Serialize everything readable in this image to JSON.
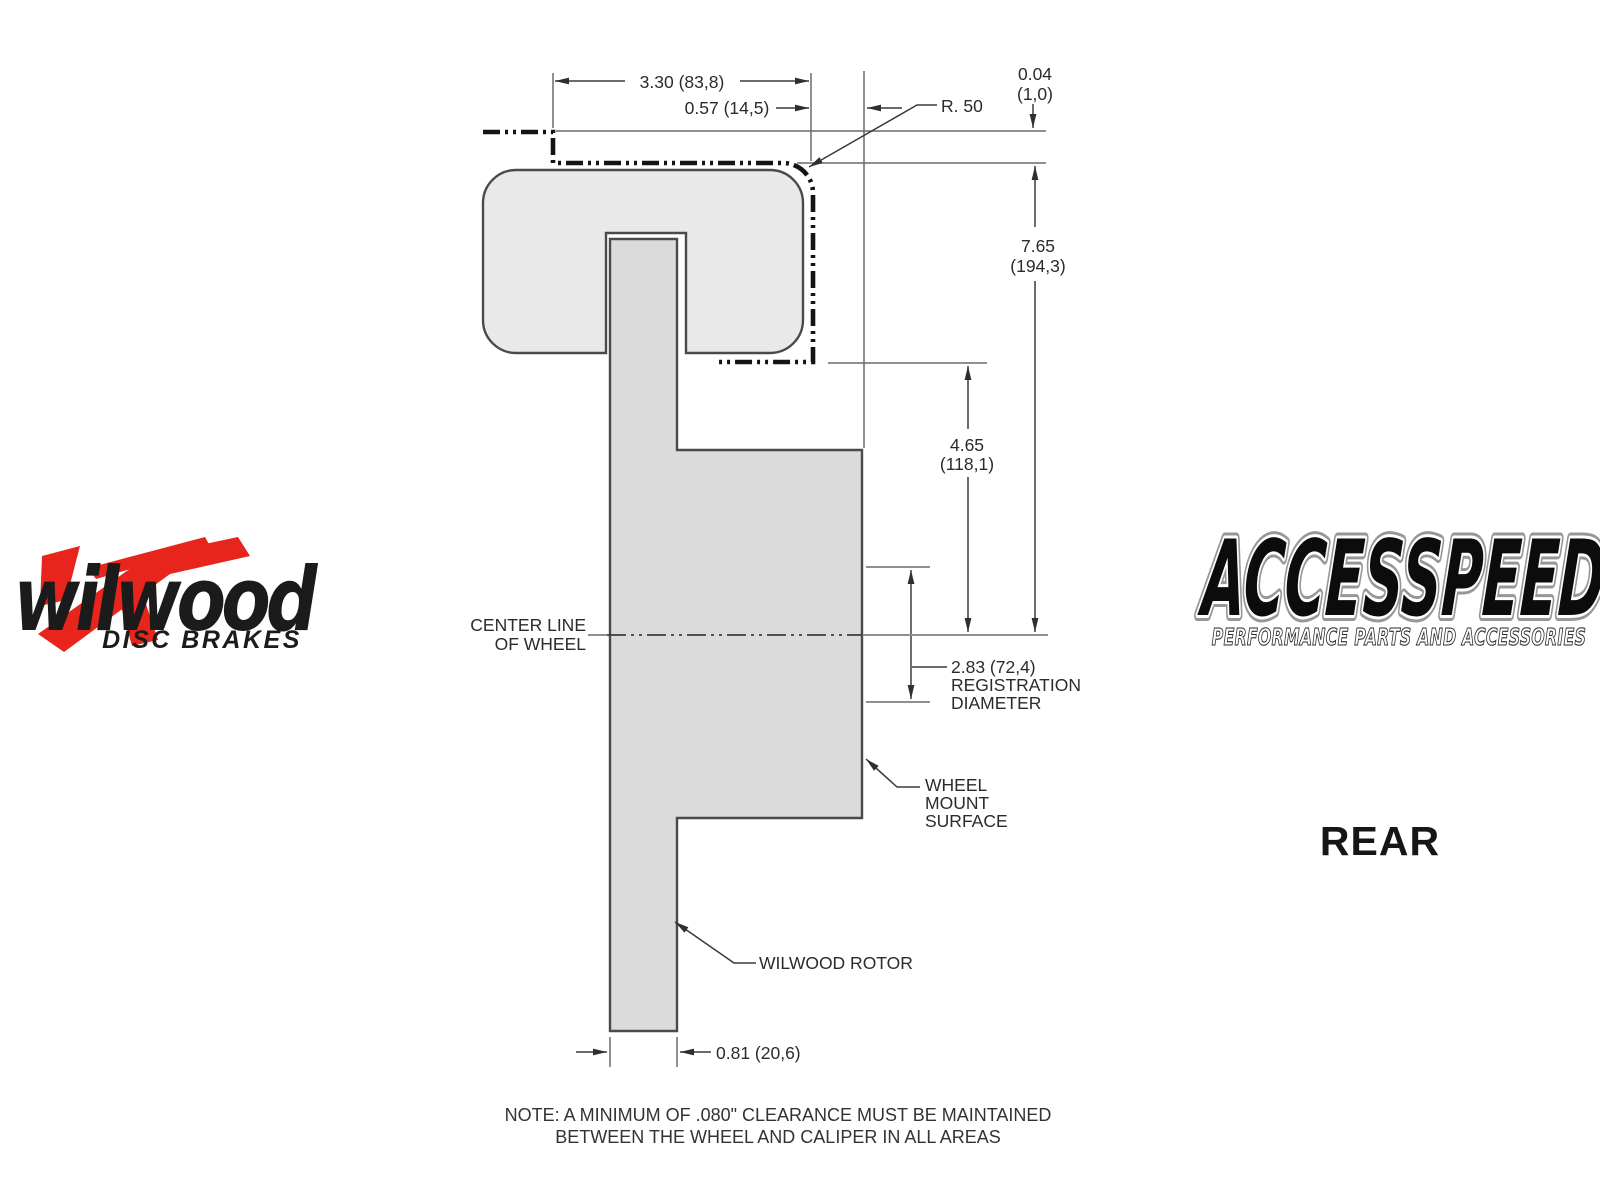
{
  "colors": {
    "accent_red": "#e8251c",
    "caliper_fill": "#e9e9e9",
    "rotor_fill": "#dbdbdb",
    "phantom_line": "#141414",
    "thin_line": "#6a6a6a",
    "text": "#2b2b2b"
  },
  "drawing": {
    "dim_3_30": "3.30 (83,8)",
    "dim_0_57": "0.57 (14,5)",
    "radius_label": "R. 50",
    "dim_0_04": {
      "inches": "0.04",
      "mm": "(1,0)"
    },
    "dim_7_65": {
      "inches": "7.65",
      "mm": "(194,3)"
    },
    "dim_4_65": {
      "inches": "4.65",
      "mm": "(118,1)"
    },
    "dim_2_83": {
      "value": "2.83 (72,4)",
      "label_line1": "REGISTRATION",
      "label_line2": "DIAMETER"
    },
    "centerline": {
      "line1": "CENTER LINE",
      "line2": "OF WHEEL"
    },
    "wheel_mount": {
      "line1": "WHEEL",
      "line2": "MOUNT",
      "line3": "SURFACE"
    },
    "rotor_label": "WILWOOD ROTOR",
    "dim_0_81": "0.81 (20,6)",
    "note": {
      "line1": "NOTE: A MINIMUM OF .080\" CLEARANCE MUST BE MAINTAINED",
      "line2": "BETWEEN THE WHEEL AND CALIPER IN ALL AREAS"
    }
  },
  "branding": {
    "wilwood": {
      "name": "wilwood",
      "tagline": "DISC BRAKES"
    },
    "accesspeed": {
      "name": "ACCESSPEED",
      "tagline": "PERFORMANCE PARTS AND ACCESSORIES"
    },
    "view_label": "REAR"
  }
}
